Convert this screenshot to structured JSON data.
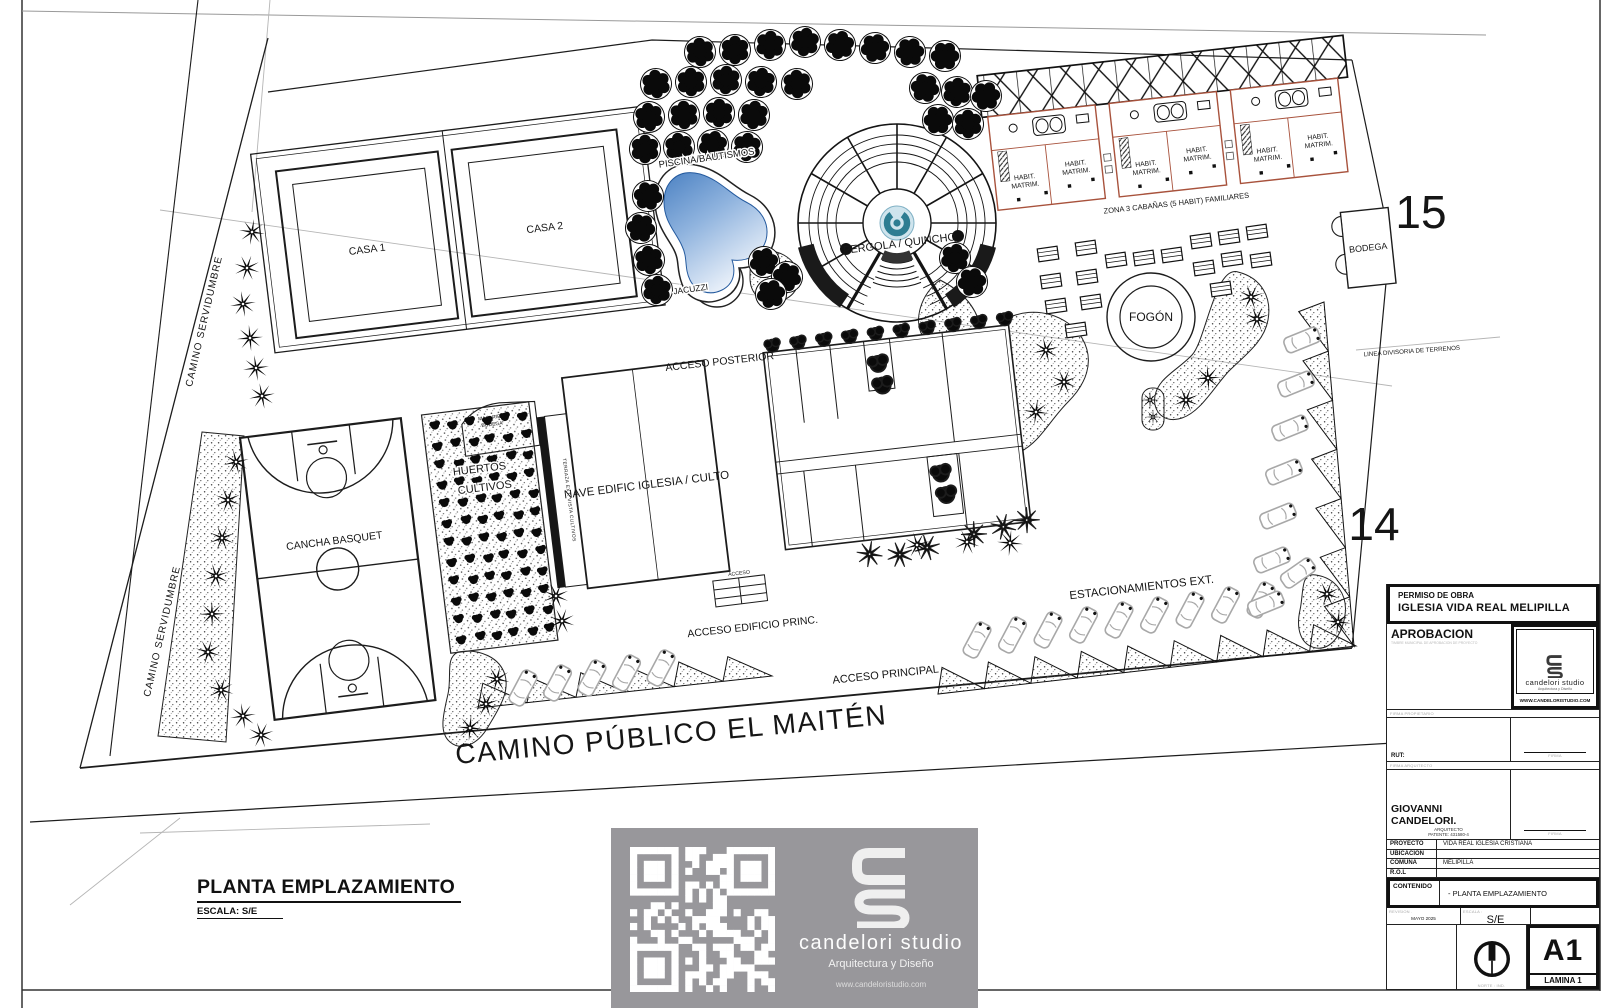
{
  "sheet": {
    "title": "PLANTA EMPLAZAMIENTO",
    "scale": "ESCALA: S/E"
  },
  "plan": {
    "camino_servidumbre": "CAMINO SERVIDUMBRE",
    "camino_publico": "CAMINO PÚBLICO EL MAITÉN",
    "acceso_principal": "ACCESO PRINCIPAL",
    "acceso_posterior": "ACCESO POSTERIOR",
    "acceso_edificio": "ACCESO EDIFICIO PRINC.",
    "acceso": "ACCESO",
    "estacionamientos": "ESTACIONAMIENTOS EXT.",
    "linea_divisoria": "LINEA DIVISORIA DE TERRENOS",
    "casa1": "CASA 1",
    "casa2": "CASA 2",
    "piscina": "PISCINA/BAUTISMOS",
    "jacuzzi": "JACUZZI",
    "pergola": "PERGOLA / QUINCHO",
    "fogon": "FOGÓN",
    "bodega": "BODEGA",
    "maq_riego_1": "MAQ. RIEGO",
    "maq_riego_2": "BODEGA",
    "huertos_1": "HUERTOS",
    "huertos_2": "CULTIVOS",
    "terraza": "TERRAZA EXT. VISTA CULTIVOS",
    "nave": "NAVE EDIFIC IGLESIA / CULTO",
    "cancha": "CANCHA BASQUET",
    "zona_cabanas": "ZONA 3 CABAÑAS (5 HABIT) FAMILIARES",
    "habit_1": "HABIT.",
    "habit_2": "MATRIM.",
    "parcel_15": "15",
    "parcel_14": "14"
  },
  "titleblock": {
    "permiso_header": "PERMISO DE OBRA",
    "permiso_title": "IGLESIA VIDA REAL MELIPILLA",
    "aprobacion": "APROBACION",
    "aprobacion_sub": "TIMBRE MUNICIPAL DE APROBACION DE PROYECTO",
    "studio_name": "candelori studio",
    "studio_tag": "Arquitectura y Diseño",
    "studio_web": "WWW.CANDELORISTUDIO.COM",
    "firma_propietario": "FIRMA PROPIETARIO",
    "rut": "RUT:",
    "firma": "FIRMA",
    "firma_arquitecto": "FIRMA ARQUITECTO",
    "arquitecto": "GIOVANNI CANDELORI.",
    "arquitecto_cargo": "ARQUITECTO",
    "patente": "PATENTE: 431580-4",
    "rows": [
      {
        "label": "PROYECTO",
        "value": "VIDA REAL IGLESIA CRISTIANA"
      },
      {
        "label": "UBICACION",
        "value": ""
      },
      {
        "label": "COMUNA",
        "value": "MELIPILLA"
      },
      {
        "label": "R.O.L",
        "value": ""
      }
    ],
    "contenido": "CONTENIDO",
    "contenido_value": "- PLANTA EMPLAZAMIENTO",
    "revision": "REVISION .",
    "revision_value": "MAYO 2025",
    "escala": "ESCALA :",
    "escala_value": "S/E",
    "norte": "NORTE : IND.",
    "formato": "A1",
    "lamina": "LAMINA 1"
  },
  "footer_logo": {
    "name": "candelori studio",
    "tag": "Arquitectura y Diseño",
    "web": "www.candeloristudio.com"
  }
}
